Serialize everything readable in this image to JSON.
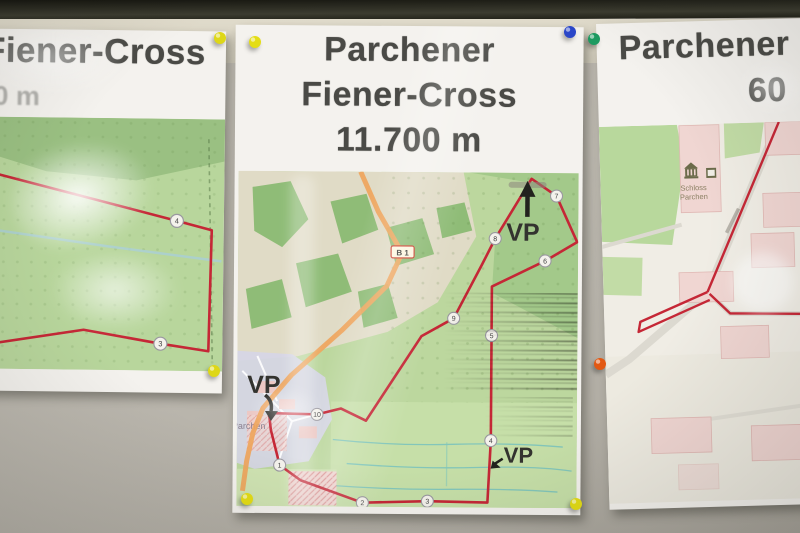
{
  "scene": {
    "description": "Three laminated cross-country course maps pinned to a wall"
  },
  "posters": {
    "left": {
      "title": "Fiener-Cross",
      "distance_partial": "0 m",
      "waypoints": [
        "4",
        "3"
      ]
    },
    "center": {
      "title_line1": "Parchener",
      "title_line2": "Fiener-Cross",
      "title_line3": "11.700 m",
      "vp_label": "VP",
      "road_shield": "B 1",
      "village_label": "Parchen",
      "waypoints": [
        "1",
        "2",
        "3",
        "4",
        "5",
        "6",
        "7",
        "8",
        "9",
        "10"
      ]
    },
    "right": {
      "title_line1": "Parchener",
      "title_line2_partial": "60",
      "poi_label_line1": "Schloss",
      "poi_label_line2": "Parchen"
    }
  },
  "pins": [
    {
      "name": "yellow-pin-left-poster-top-right",
      "color": "#ded717"
    },
    {
      "name": "yellow-pin-center-poster-top-left",
      "color": "#e4dd15"
    },
    {
      "name": "blue-pin-center-poster-top-right",
      "color": "#2a46c8"
    },
    {
      "name": "green-pin-right-poster-top-left",
      "color": "#1d9a60"
    },
    {
      "name": "yellow-pin-left-poster-bottom-right",
      "color": "#ded717"
    },
    {
      "name": "yellow-pin-center-poster-bottom-left",
      "color": "#e4dd15"
    },
    {
      "name": "yellow-pin-center-poster-bottom-right",
      "color": "#e4dd15"
    },
    {
      "name": "orange-pin-right-poster-left-edge",
      "color": "#e25812"
    }
  ],
  "colors": {
    "route": "#c52736",
    "road_b1": "#efa55c",
    "forest": "#8fbc77",
    "field_beige": "#e0dbc6",
    "title_text": "#4a4a46"
  }
}
